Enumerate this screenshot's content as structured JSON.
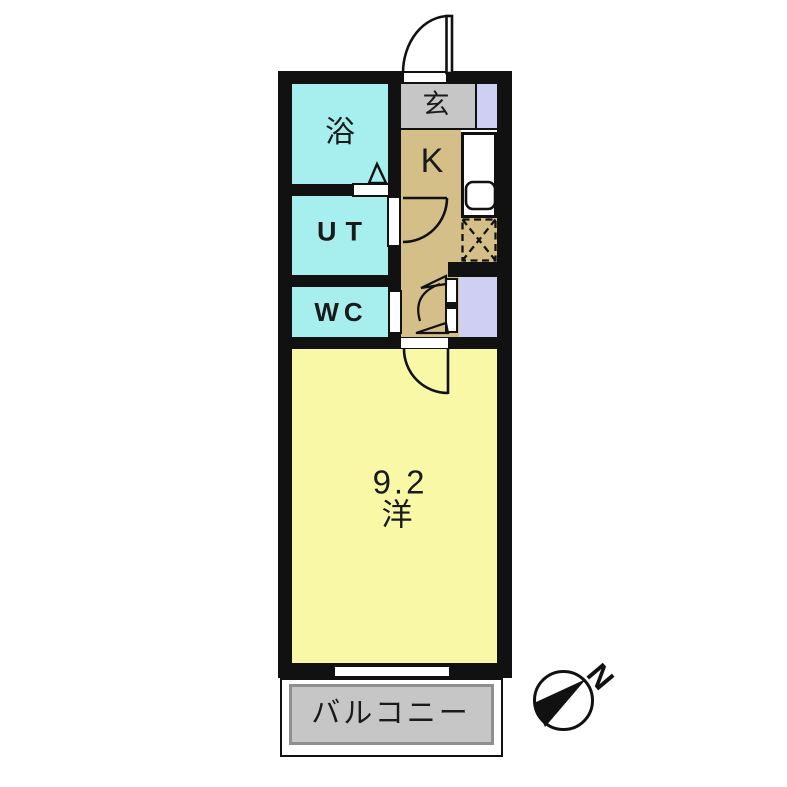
{
  "floorplan": {
    "rooms": {
      "bath": {
        "label": "浴"
      },
      "utility": {
        "label": "UT"
      },
      "toilet": {
        "label": "WC"
      },
      "entrance": {
        "label": "玄"
      },
      "kitchen": {
        "label": "K"
      },
      "main_room": {
        "size": "9.2",
        "type": "洋"
      },
      "balcony": {
        "label": "バルコニー"
      }
    },
    "compass": {
      "north": "N"
    },
    "colors": {
      "wet_rooms": "#a7efef",
      "kitchen_hall": "#d5bf88",
      "main_room": "#f8f8a6",
      "entrance_floor": "#c6c6c6",
      "closet": "#cfcff4",
      "balcony_floor": "#c6c6c6",
      "walls": "#111111"
    }
  }
}
